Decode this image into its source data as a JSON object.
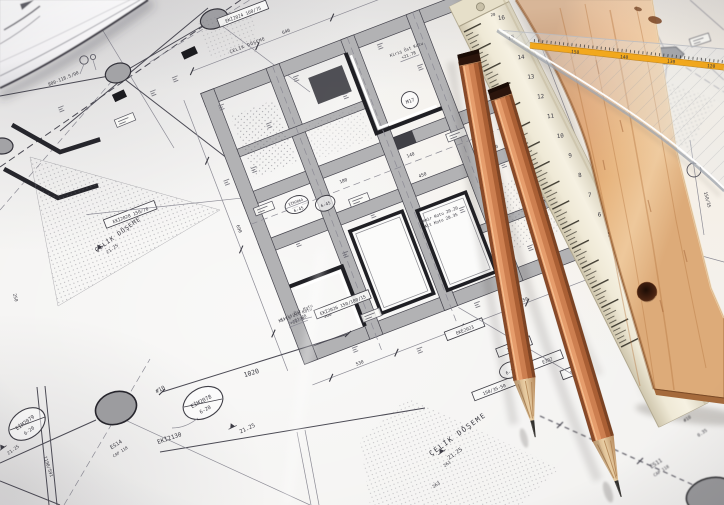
{
  "colors": {
    "paper": "#f2f1ef",
    "ink": "#45444d",
    "beam_gray": "#b2b2b4",
    "accent_dark": "#26262c",
    "pencil_orange": "#cd7f50",
    "wood": "#d99a66",
    "ruler_cream": "#efe8d6",
    "stripe_yellow": "#f2a81d"
  },
  "blueprint": {
    "labels": {
      "celik_doseme": "ÇELİK DÖŞEME",
      "kiris_ust_kotu": "Kiriş Üst Kotu",
      "level_2178": "+21.78",
      "level_2125": "21.25",
      "demir_kotu": "Demir Kotu 20.20",
      "alt_kotu": "Alt Kotu 20.35",
      "tag_eki2024": "EKİ2024 160/75",
      "tag_eki2026": "EKİ2026 150/100/15",
      "tag_eke2023": "EKE2023",
      "tag_eki2028": "EKİ2028 150/70",
      "tag_150_35_50": "150/35-50",
      "tag_150_35": "150/35",
      "tag_50_35": "50/35",
      "tag_e302": "E302",
      "tag_eim2064": "EİM2064",
      "tag_6_45": "6-45",
      "tag_m17": "M17",
      "tag_6_10": "6-10",
      "tag_eim2078": "EİM2078",
      "tag_eim2079": "EİM2079",
      "tag_6_20": "6-20",
      "tag_eki2130": "EKİ2130",
      "tag_es14": "ES14",
      "tag_es11": "ES11",
      "tag_cap118": "CAP 118",
      "dim_800": "800-118.5/90",
      "dim_1190": "1190/591",
      "dim_1020": "1020",
      "rebar_10": "#10",
      "dim_360": "360",
      "dim_530": "530",
      "dim_550": "550",
      "dim_450": "450",
      "dim_250": "250",
      "dim_180": "180",
      "dim_140": "140",
      "dim_90": "90",
      "dim_690": "690",
      "dim_640": "640",
      "dim_261": "261",
      "dim_263": "263",
      "dim_035": "0.35"
    }
  },
  "rulers": {
    "folding_numbers": [
      "16",
      "15",
      "14",
      "13",
      "12",
      "11",
      "10",
      "9",
      "8",
      "7",
      "6",
      "5",
      "4",
      "3",
      "2"
    ],
    "folding_top_numbers": [
      "19",
      "20"
    ],
    "set_square_numbers": [
      "150",
      "140",
      "130",
      "120"
    ]
  }
}
